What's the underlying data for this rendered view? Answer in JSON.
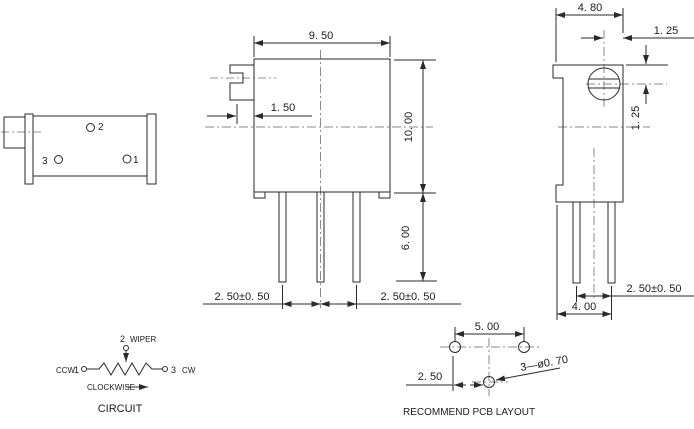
{
  "front_view": {
    "dim_body_width": "9. 50",
    "dim_shaft_protrusion": "1. 50",
    "dim_body_height": "10. 00",
    "dim_pin_length": "6. 00",
    "dim_pin_pitch_left": "2. 50±0. 50",
    "dim_pin_pitch_right": "2. 50±0. 50"
  },
  "right_view": {
    "dim_body_depth": "4. 80",
    "dim_screw_offset_h": "1. 25",
    "dim_screw_offset_v": "1. 25",
    "dim_pin_pitch": "2. 50±0. 50",
    "dim_pin_row_offset": "4. 00"
  },
  "side_view": {
    "pin2_label": "2",
    "pin3_label": "3",
    "pin1_label": "1"
  },
  "circuit": {
    "pin2_label": "2",
    "wiper_label": "WIPER",
    "ccw_label": "CCW",
    "pin1_label": "1",
    "pin3_label": "3",
    "cw_label": "CW",
    "clockwise_label": "CLOCKWISE",
    "title": "CIRCUIT"
  },
  "pcb_layout": {
    "dim_hole_span": "5. 00",
    "dim_hole_offset": "2. 50",
    "hole_note": "3—ø0. 70",
    "title": "RECOMMEND PCB LAYOUT"
  }
}
